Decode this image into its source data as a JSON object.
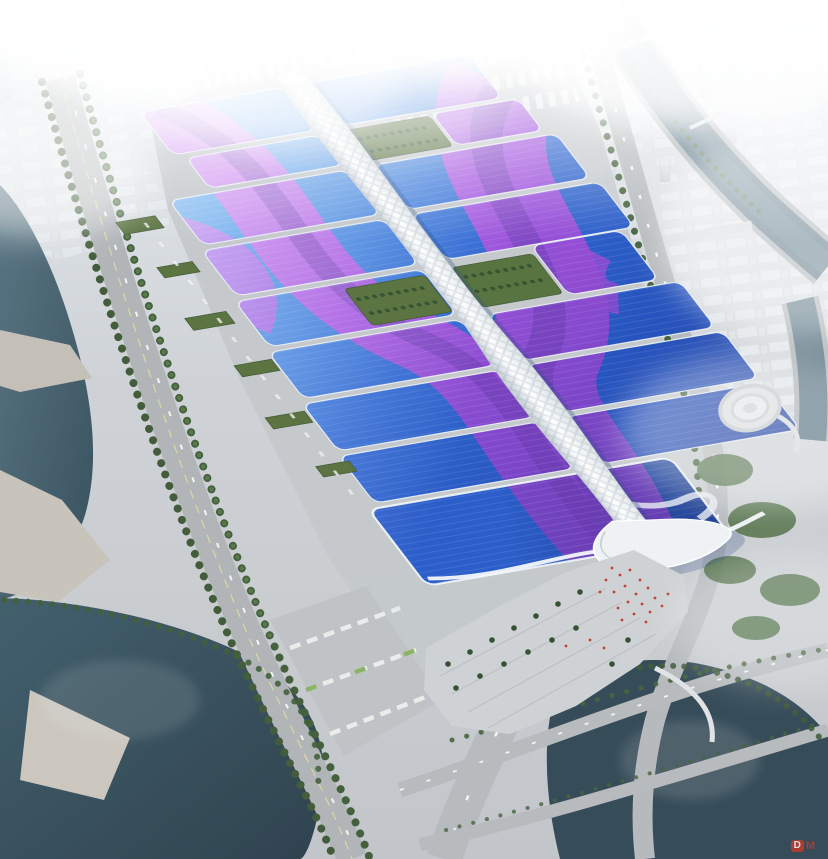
{
  "meta": {
    "title": "Aerial architectural rendering of a riverside exhibition and convention center",
    "canvas": {
      "width": 828,
      "height": 859
    }
  },
  "watermark": {
    "logo_letter": "D",
    "text": "M",
    "color": "#c7392c"
  },
  "scene": {
    "description": "Bird's-eye rendering: two columns of wave-roofed exhibition halls with blue roofs and sweeping purple ribbons, joined by a white serpentine central canopy that ends in a wave-shaped south entrance hall and plaza; surrounded by canals, a river with locks, highways, truck and bus lots, tree rows and a hazy white city skyline.",
    "complex": {
      "hall_rows": 8,
      "hall_columns": 2,
      "roof_color_light": "#79c0f2",
      "roof_color_primary": "#2a64d2",
      "roof_color_deep": "#142f86",
      "south_hall_color": "#0e2d7c",
      "ribbon_colors": [
        "#cf7cf0",
        "#a74fe0",
        "#7b3ec6",
        "#5834a8"
      ],
      "spine_color": "#eef2f5",
      "green_roof_color": "#566f3b"
    },
    "environment": {
      "water_color": "#314b58",
      "canal_color": "#4e6b7a",
      "ground_color": "#c2c6c9",
      "road_color": "#b4b8bb",
      "tree_color": "#3c5634",
      "fog_color": "#ffffff",
      "crowd_dot_color": "#c03a2e"
    }
  }
}
